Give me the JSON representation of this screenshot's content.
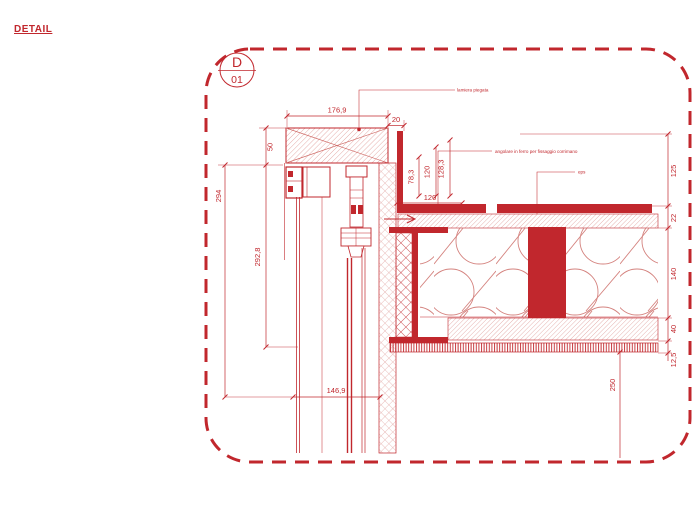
{
  "header": {
    "title": "DETAIL"
  },
  "marker": {
    "letter": "D",
    "number": "01"
  },
  "callouts": {
    "bent_sheet": "lamiera piegata",
    "iron_angle": "angolare in ferro per fissaggio corrimano",
    "eps": "eps"
  },
  "dimensions": {
    "top_width": "176,9",
    "top_offset": "20",
    "beam_height": "50",
    "left_overall": "294",
    "glazing_height": "292,8",
    "bottom_width": "146,9",
    "upstand_a": "78,3",
    "upstand_b": "120",
    "upstand_c": "128,3",
    "ledge_width": "120",
    "layer_125": "125",
    "layer_22": "22",
    "layer_140": "140",
    "layer_40": "40",
    "layer_12_5": "12,5",
    "slab_drop": "250"
  },
  "colors": {
    "line_red": "#c1272d",
    "hatch_red": "#dd938f",
    "background": "#ffffff"
  }
}
